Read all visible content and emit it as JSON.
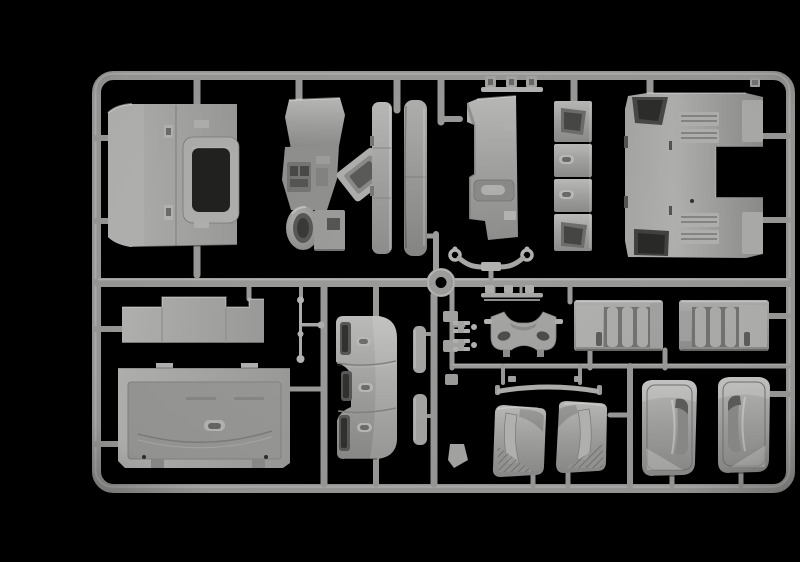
{
  "scene": {
    "description": "Photograph of a light-grey injection-moulded plastic model kit sprue with truck cab parts on a black background",
    "background_label": "black studio background"
  },
  "colors": {
    "bg": "#000000",
    "rail": "#9c9c9a",
    "rail_light": "#c6c6c4",
    "rail_dark": "#6f6f6d",
    "part": "#a9a9a7",
    "part_light": "#c0c0be",
    "part_dark": "#7a7a78",
    "recess": "#222220",
    "recess_soft": "#4a4a48"
  },
  "sprue": {
    "frame_label": "Rectangular sprue frame with rounded corners",
    "mid_rail_label": "Horizontal middle runner",
    "ring_label": "Central circular runner ring",
    "runner_label": "Runner segment"
  },
  "parts": [
    {
      "id": "cab-rear-window-panel",
      "label": "Cab rear panel with window opening"
    },
    {
      "id": "dashboard-assembly",
      "label": "Dashboard and steering column part"
    },
    {
      "id": "storage-tray",
      "label": "Angled storage tray"
    },
    {
      "id": "a-pillar-trim",
      "label": "Narrow pillar trim strip"
    },
    {
      "id": "door-trim-strip",
      "label": "Door trim strip"
    },
    {
      "id": "cab-floor-panel",
      "label": "Flat cab floor panel"
    },
    {
      "id": "clip-strip",
      "label": "Thin bar with three clips"
    },
    {
      "id": "locker-door-stack",
      "label": "Stacked locker door panels"
    },
    {
      "id": "engine-tunnel-panel",
      "label": "Large cab rear wall with engine tunnel notch"
    },
    {
      "id": "grab-handle-bracket",
      "label": "Curved bracket with ring ends"
    },
    {
      "id": "pedal-bar",
      "label": "Thin bar with small tabs"
    },
    {
      "id": "sun-visor-panel",
      "label": "Stepped flat visor panel"
    },
    {
      "id": "cab-back-wall",
      "label": "Large cab back wall panel"
    },
    {
      "id": "mirror-arm-rods",
      "label": "Thin rods with ball ends"
    },
    {
      "id": "entry-step-panel",
      "label": "Three-segment entry step panel"
    },
    {
      "id": "side-trim-strips",
      "label": "Two small side trim strips"
    },
    {
      "id": "small-brackets",
      "label": "Small mounting brackets"
    },
    {
      "id": "seat-base-frame",
      "label": "Seat base frame with oval holes"
    },
    {
      "id": "i-beam-clips",
      "label": "Small I-beam clips"
    },
    {
      "id": "step-box-left",
      "label": "Ribbed step box, left"
    },
    {
      "id": "step-box-right",
      "label": "Ribbed step box, right"
    },
    {
      "id": "roof-trim-strip",
      "label": "Long curved trim strip"
    },
    {
      "id": "corner-deflector-left",
      "label": "Corner deflector panel, left"
    },
    {
      "id": "corner-deflector-right",
      "label": "Corner deflector panel, right"
    },
    {
      "id": "side-deflector-left",
      "label": "Large side wind deflector, left"
    },
    {
      "id": "side-deflector-right",
      "label": "Large side wind deflector, right"
    },
    {
      "id": "small-clip",
      "label": "Small clip near top right corner"
    }
  ]
}
